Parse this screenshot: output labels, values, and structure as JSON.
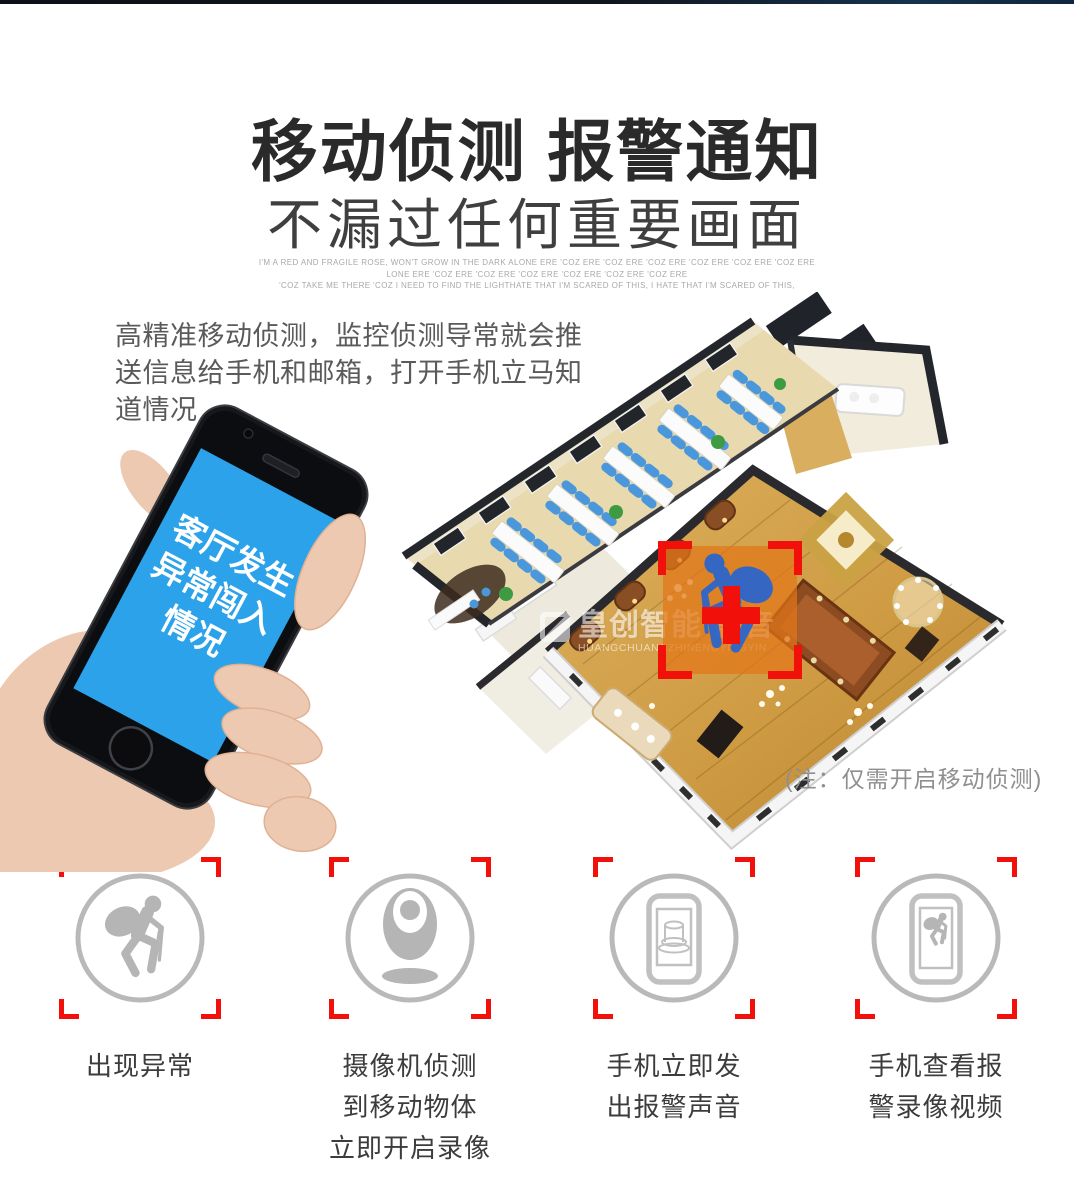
{
  "header": {
    "title": "移动侦测 报警通知",
    "subtitle": "不漏过任何重要画面",
    "fineprint": [
      "I'M A RED AND FRAGILE ROSE, WON'T GROW IN THE DARK ALONE ERE 'COZ ERE 'COZ ERE 'COZ ERE 'COZ ERE 'COZ ERE 'COZ ERE",
      "LONE ERE 'COZ ERE 'COZ ERE 'COZ ERE 'COZ ERE 'COZ ERE 'COZ ERE",
      "'COZ TAKE ME THERE 'COZ I NEED TO FIND THE LIGHTHATE THAT I'M SCARED OF THIS, I HATE THAT I'M SCARED OF THIS,"
    ]
  },
  "description": {
    "line1": "高精准移动侦测，监控侦测导常就会推",
    "line2": "送信息给手机和邮箱，打开手机立马知道情况"
  },
  "phone": {
    "screen_lines": [
      "客厅发生",
      "异常闯入",
      "情况"
    ]
  },
  "floorplan": {
    "note": "(注：仅需开启移动侦测)",
    "watermark_cn": "皇创智能·影音",
    "watermark_en": "HUANGCHUANGZHINENGYINGYIN"
  },
  "features": [
    {
      "lines": [
        "出现异常"
      ]
    },
    {
      "lines": [
        "摄像机侦测",
        "到移动物体",
        "立即开启录像"
      ]
    },
    {
      "lines": [
        "手机立即发",
        "出报警声音"
      ]
    },
    {
      "lines": [
        "手机查看报",
        "警录像视频"
      ]
    }
  ],
  "colors": {
    "accent-red": "#f2100b",
    "screen-blue": "#2ba2e9",
    "detect-orange": "rgba(226,118,24,0.72)",
    "thief-blue": "#2d66cb",
    "icon-gray": "#b5b5b5",
    "title-dark": "#2a2a2a",
    "wood-gold": "#cf9c44",
    "floor-tan": "#e8d9ae"
  }
}
